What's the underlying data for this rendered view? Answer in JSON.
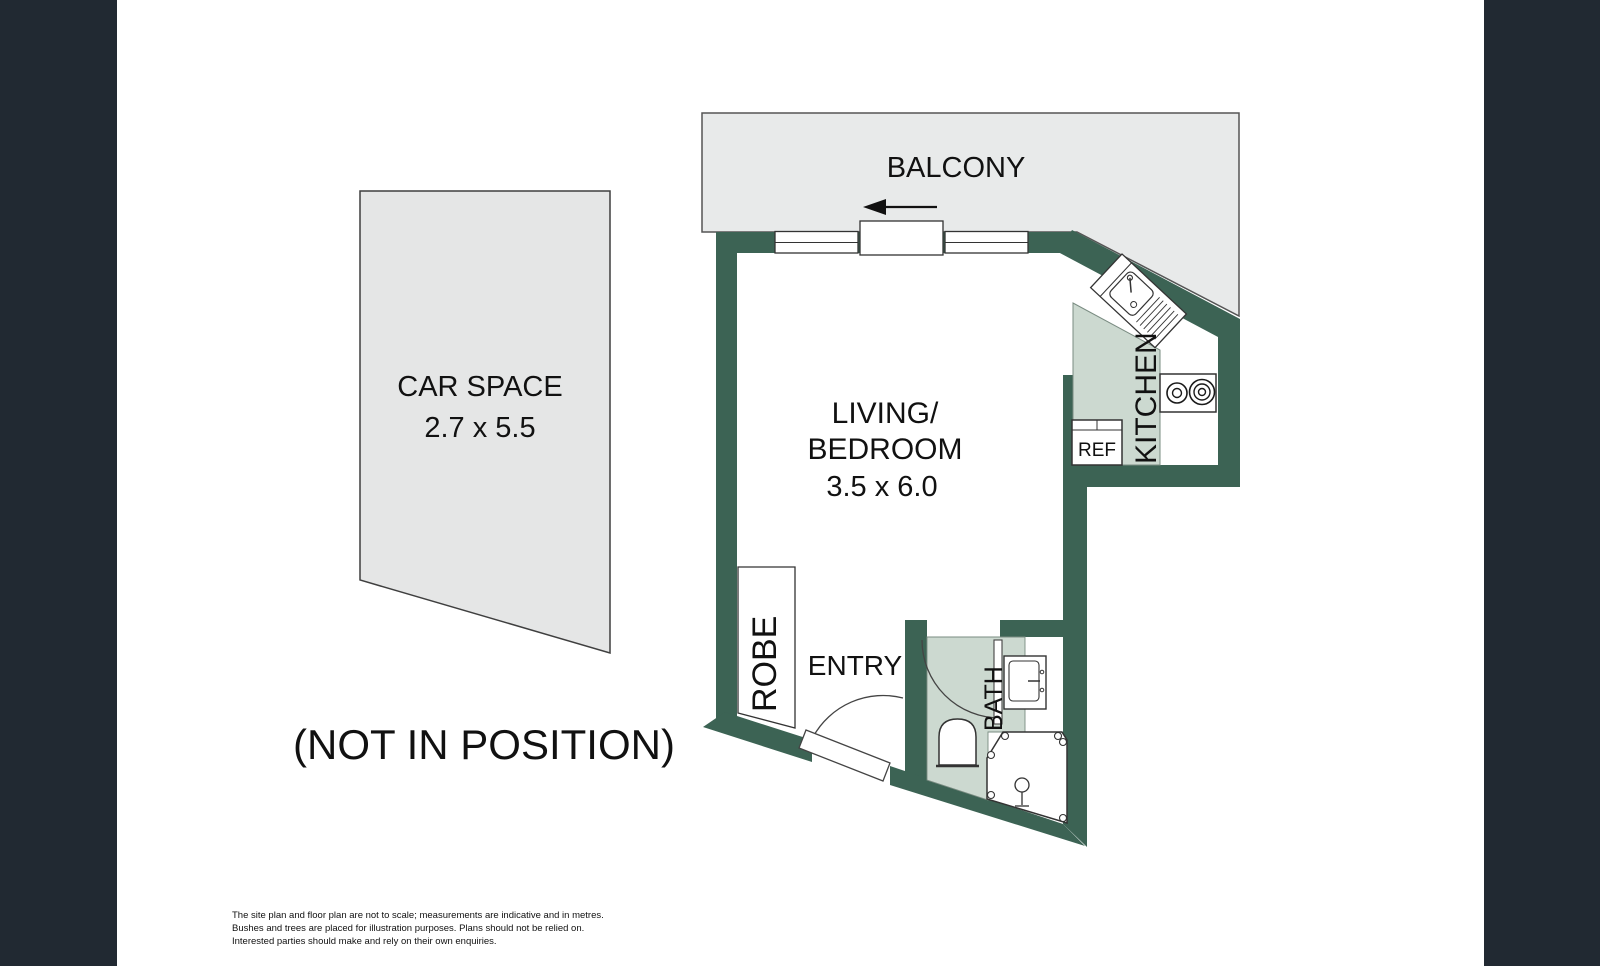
{
  "plan": {
    "balcony_label": "BALCONY",
    "living_label_line1": "LIVING/",
    "living_label_line2": "BEDROOM",
    "living_dims": "3.5 x 6.0",
    "kitchen_label": "KITCHEN",
    "ref_label": "REF",
    "robe_label": "ROBE",
    "entry_label": "ENTRY",
    "bath_label": "BATH",
    "car_space_label": "CAR SPACE",
    "car_space_dims": "2.7 x 5.5",
    "car_space_note": "(NOT IN POSITION)"
  },
  "disclaimer": {
    "line1": "The site plan and floor plan are not to scale; measurements are indicative and in metres.",
    "line2": "Bushes and trees are placed for illustration purposes. Plans should not be relied on.",
    "line3": "Interested parties should make and rely on their own enquiries."
  },
  "colors": {
    "wall": "#3c6354",
    "floor_tint": "#ccd9d0",
    "balcony_fill": "#e8eaea",
    "carspace_fill": "#e5e6e6",
    "sidebar": "#212932",
    "line": "#333333"
  }
}
